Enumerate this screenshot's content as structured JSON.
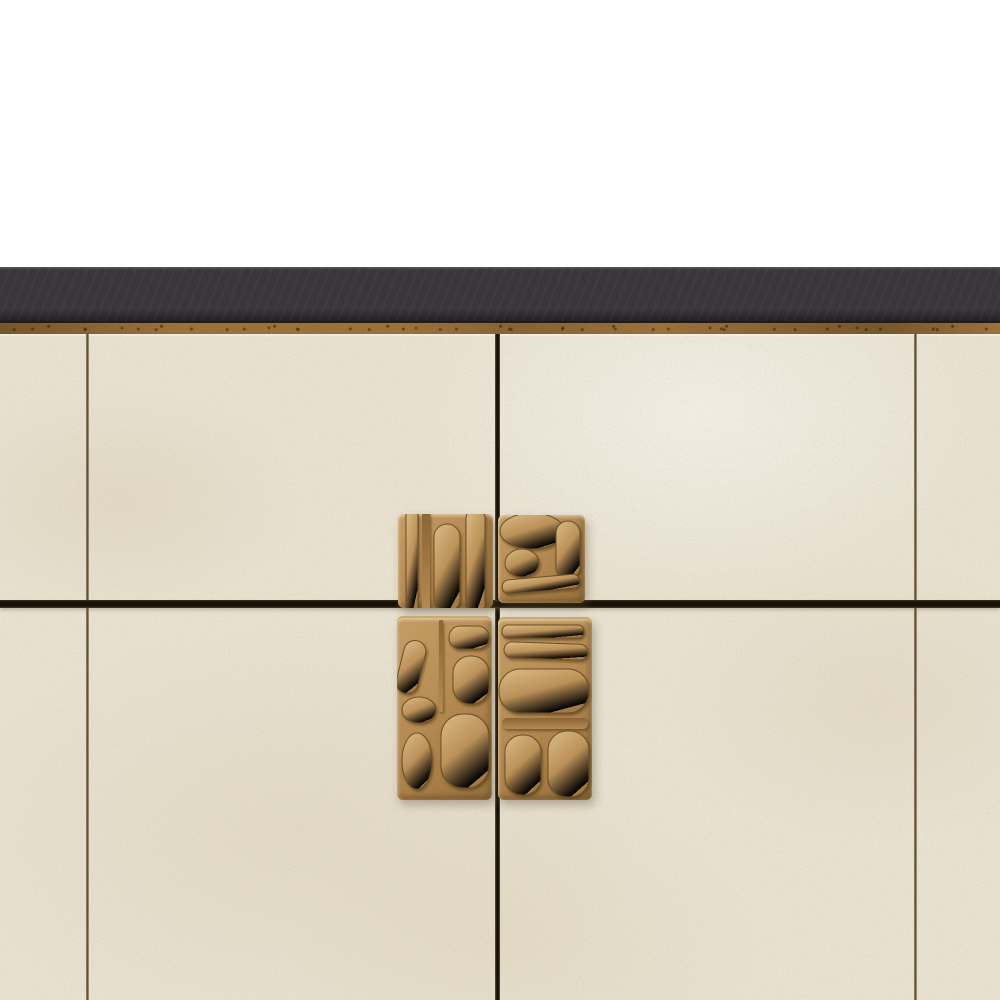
{
  "scene": {
    "description": "Close-up product render of a modern sideboard cabinet on a white studio background: a charcoal slate top slab over an aged bronze trim strip, cream shagreen-textured door panels separated by dark reveal seams, and four sculpted cast-bronze relief handle blocks clustered around the central seam cross.",
    "background_label": "studio white backdrop"
  },
  "colors": {
    "bg": "#ffffff",
    "slab": "#3a383b",
    "slab-edge": "#5a575d",
    "slab-shadow": "#232025",
    "trim": "#a1773f",
    "trim-dark": "#7c5a2e",
    "trim-line": "#241d12",
    "cream": "#ece6d6",
    "cream-light": "#f4f1e5",
    "cream-shade": "#ddd4c0",
    "seam": "#4f4433",
    "seam-dark": "#171106",
    "bronze-light": "#dcbc86",
    "bronze": "#b68c55",
    "bronze-mid": "#a67c46",
    "bronze-dark": "#6e4f26",
    "bronze-deep": "#4e3717"
  },
  "parts": {
    "backdrop": "white studio background",
    "top_slab": "charcoal slate countertop slab",
    "bronze_trim": "aged bronze trim strip",
    "front": "cream shagreen door front",
    "seam_left": "left door reveal seam",
    "seam_center": "central door gap",
    "seam_right": "right door reveal seam",
    "seam_horizontal": "horizontal drawer reveal seam",
    "handle_top_left": "sculpted bronze handle block, upper left",
    "handle_top_right": "sculpted bronze handle block, upper right",
    "handle_bottom_left": "sculpted bronze handle block, lower left",
    "handle_bottom_right": "sculpted bronze handle block, lower right"
  }
}
